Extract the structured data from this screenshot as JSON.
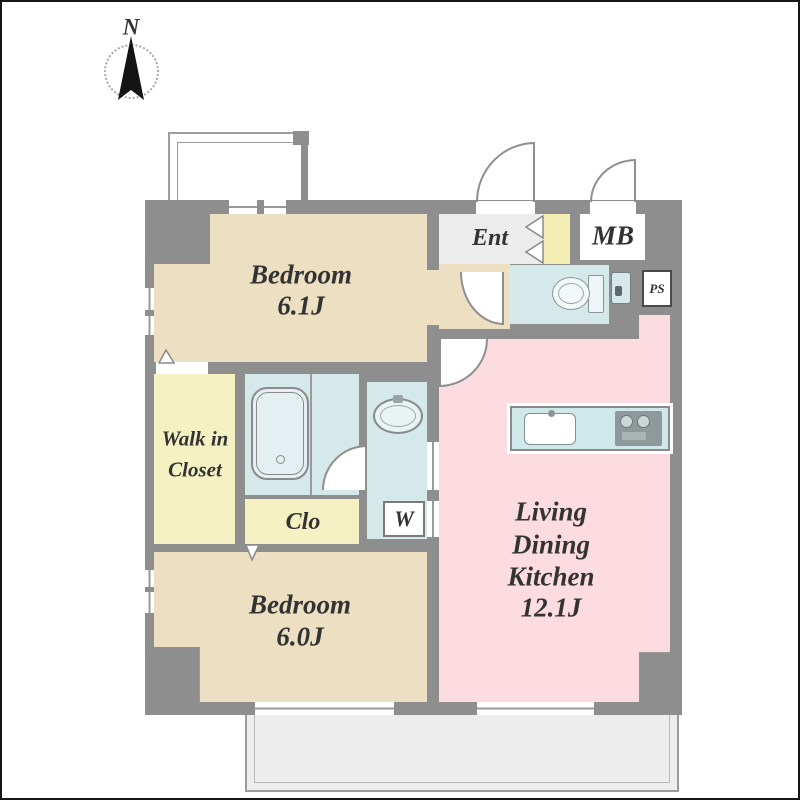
{
  "title": "apartment-floor-plan",
  "compass": {
    "label": "N"
  },
  "rooms": {
    "bedroom1": {
      "label": "Bedroom",
      "area": "6.1J"
    },
    "bedroom2": {
      "label": "Bedroom",
      "area": "6.0J"
    },
    "ldk": {
      "lines": [
        "Living",
        "Dining",
        "Kitchen",
        "12.1J"
      ]
    },
    "walk_in_closet": {
      "lines": [
        "Walk in",
        "Closet"
      ]
    },
    "closet": {
      "label": "Clo"
    },
    "washer": {
      "label": "W"
    },
    "entrance": {
      "label": "Ent"
    },
    "meter_box": {
      "label": "MB"
    },
    "pipe_space": {
      "label": "PS"
    }
  },
  "fixtures": [
    "bathtub",
    "toilet",
    "washbasin",
    "kitchen-sink",
    "stove",
    "hand-basin",
    "washing-machine-space"
  ],
  "colors": {
    "wall": "#8e8e8e",
    "bedroom_beige": "#ecdfc2",
    "closet_yellow": "#f6f1c3",
    "wet_area_blue": "#d5e9eb",
    "ldk_pink": "#fcdce1",
    "entrance_floor": "#ececec",
    "shoe_cabinet_yellow": "#f4edb4",
    "balcony_gray": "#ededed"
  }
}
